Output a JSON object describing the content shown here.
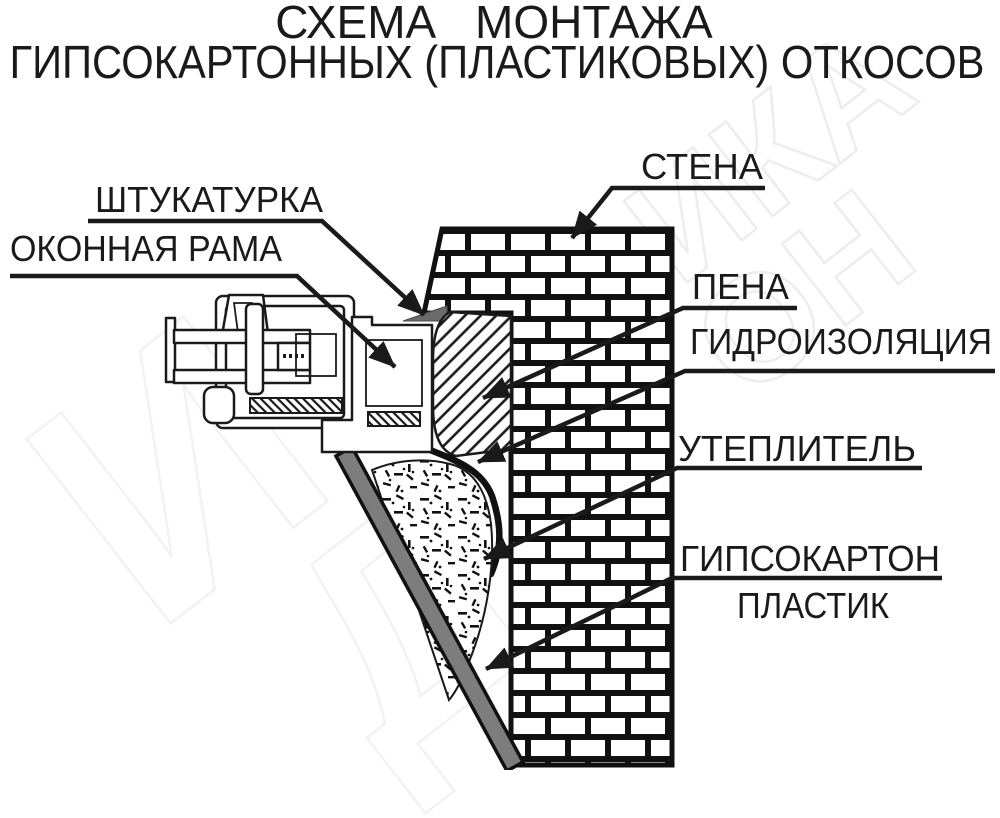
{
  "title": {
    "line1": "СХЕМА МОНТАЖА",
    "line2": "ГИПСОКАРТОННЫХ (ПЛАСТИКОВЫХ) ОТКОСОВ"
  },
  "labels": {
    "plaster": "ШТУКАТУРКА",
    "window_frame": "ОКОННАЯ РАМА",
    "wall": "СТЕНА",
    "foam": "ПЕНА",
    "waterproofing": "ГИДРОИЗОЛЯЦИЯ",
    "insulation": "УТЕПЛИТЕЛЬ",
    "drywall": "ГИПСОКАРТОН",
    "plastic": "ПЛАСТИК"
  },
  "watermark": {
    "fragment1": "ИКА",
    "fragment2": "ОН",
    "fragment3": "И",
    "fragment4": "Д"
  },
  "colors": {
    "line": "#1a1a1a",
    "background": "#ffffff",
    "slope_panel": "#7d7d7d",
    "plaster_wedge": "#6b6b6b",
    "watermark": "#ededed"
  }
}
